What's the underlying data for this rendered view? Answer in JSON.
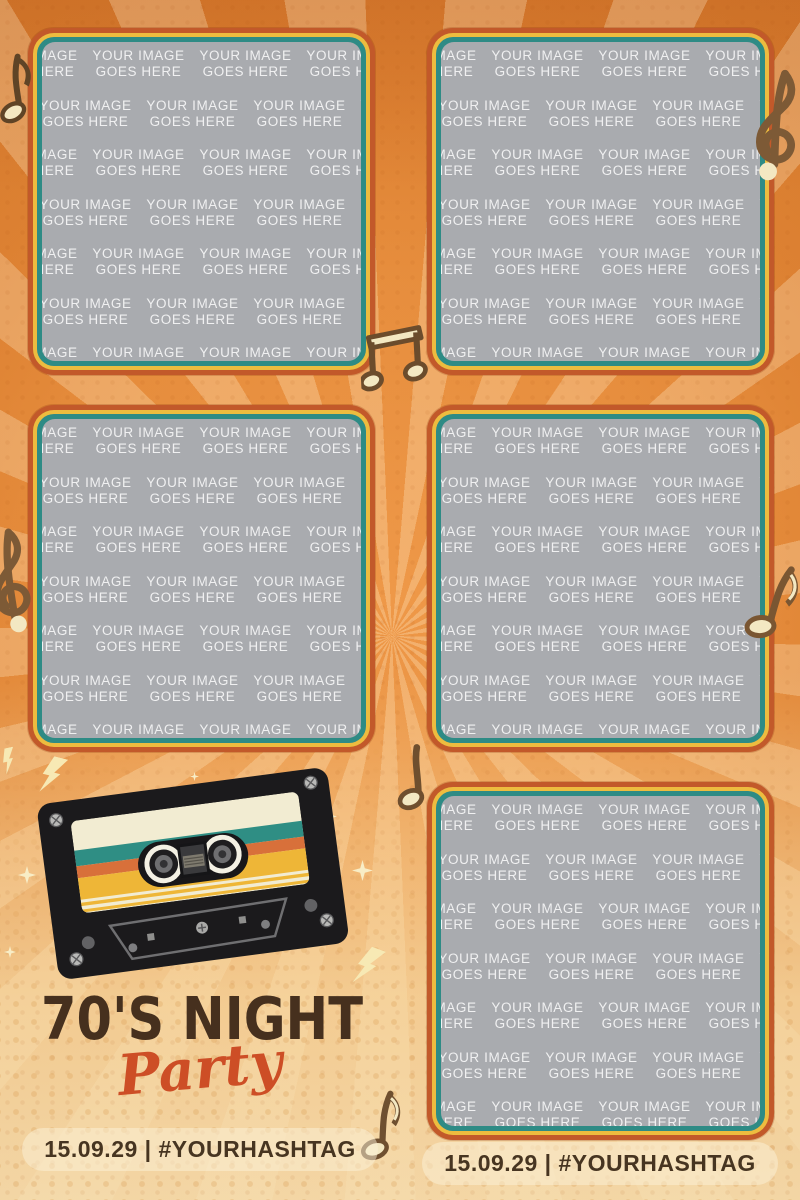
{
  "poster": {
    "title": "70'S NIGHT",
    "subtitle": "Party",
    "event_info_left": "15.09.29 | #YOURHASHTAG",
    "event_info_right": "15.09.29 | #YOURHASHTAG",
    "photo_placeholder": {
      "line1": "YOUR IMAGE",
      "line2": "GOES HERE"
    },
    "photo_slots": [
      {
        "id": "photo-slot-top-left",
        "position": "top-left"
      },
      {
        "id": "photo-slot-top-right",
        "position": "top-right"
      },
      {
        "id": "photo-slot-middle-left",
        "position": "middle-left"
      },
      {
        "id": "photo-slot-middle-right",
        "position": "middle-right"
      },
      {
        "id": "photo-slot-bottom-right",
        "position": "bottom-right"
      }
    ],
    "decorations": {
      "cassette": "retro-cassette-tape",
      "music_notes": [
        "eighth-note-top-left",
        "treble-clef-top-right",
        "beamed-notes-center",
        "treble-clef-middle-left",
        "eighth-note-middle-right",
        "quarter-note-above-bottom-slot",
        "eighth-note-bottom-center"
      ],
      "accents": [
        "four-point-sparkles",
        "lightning-bolts"
      ]
    },
    "palette": {
      "background_orange": "#e5893a",
      "background_cream": "#f5d8a3",
      "frame_red_orange": "#c2592a",
      "frame_yellow": "#edbc3f",
      "frame_teal": "#2e8b85",
      "photo_gray": "#a9abaf",
      "watermark_white": "#ffffff",
      "title_brown": "#46301e",
      "subtitle_orange": "#cd4e26",
      "info_brown": "#473521",
      "note_brown": "#6f4f2e",
      "accent_cream": "#f3e8c2",
      "cassette_black": "#1b1a1c",
      "label_cream": "#f2ecd2",
      "label_teal": "#2f8e84",
      "label_orange": "#d8703a",
      "label_yellow": "#eeb637"
    }
  }
}
